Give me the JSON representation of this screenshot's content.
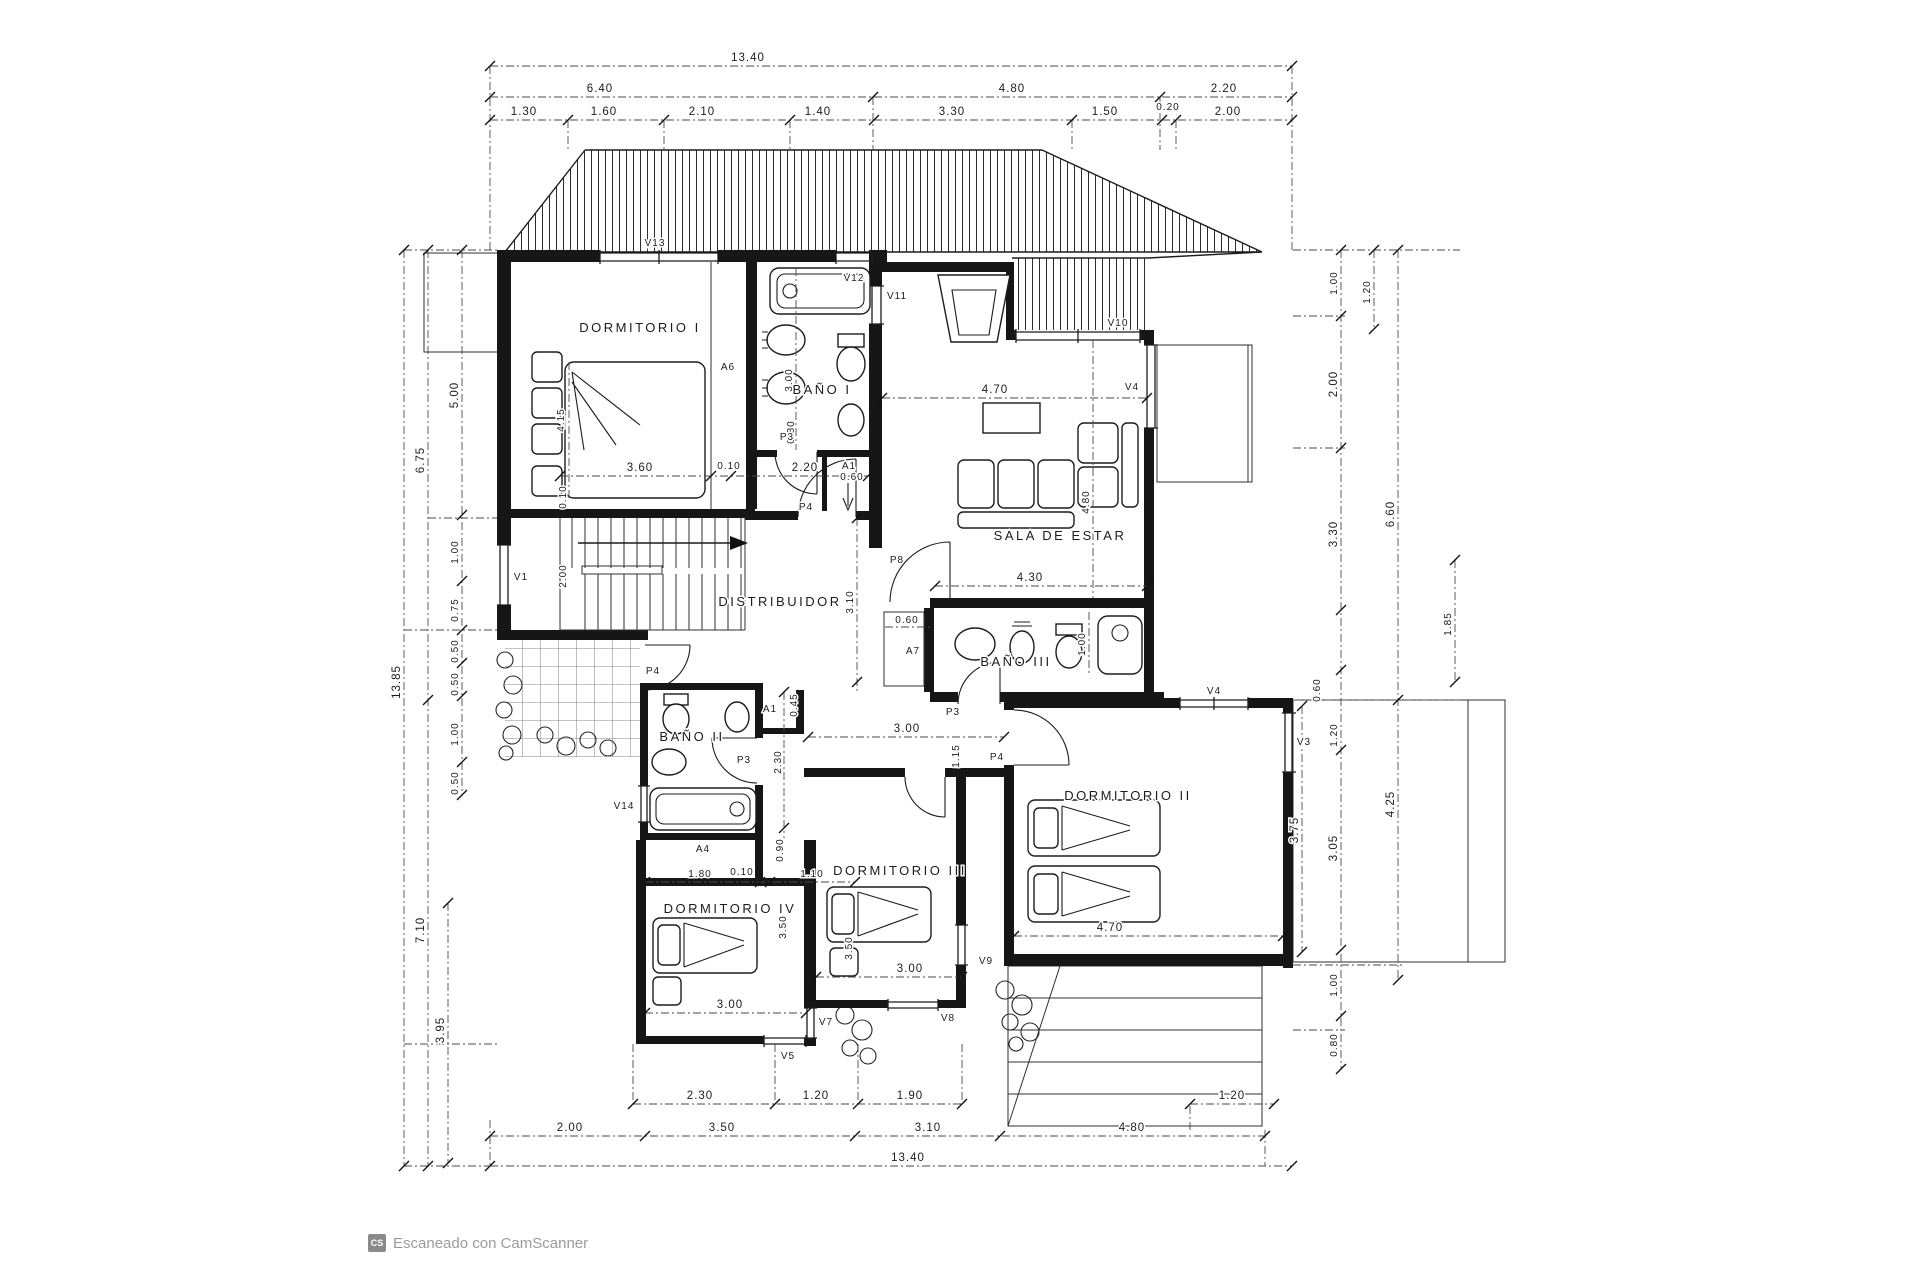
{
  "watermark": {
    "logo": "CS",
    "text": "Escaneado con CamScanner"
  },
  "rooms": {
    "dormitorio1": "DORMITORIO I",
    "bano1": "BAÑO I",
    "sala": "SALA DE ESTAR",
    "distribuidor": "DISTRIBUIDOR",
    "bano2": "BAÑO II",
    "bano3": "BAÑO III",
    "dormitorio2": "DORMITORIO II",
    "dormitorio3": "DORMITORIO III",
    "dormitorio4": "DORMITORIO IV"
  },
  "doors": {
    "p3": "P3",
    "p4": "P4",
    "p8": "P8"
  },
  "windows": {
    "v1": "V1",
    "v3": "V3",
    "v4": "V4",
    "v5": "V5",
    "v7": "V7",
    "v8": "V8",
    "v9": "V9",
    "v10": "V10",
    "v11": "V11",
    "v12": "V12",
    "v13": "V13",
    "v14": "V14"
  },
  "closets": {
    "a1": "A1",
    "a4": "A4",
    "a6": "A6",
    "a7": "A7"
  },
  "v": {
    "13_40": "13.40",
    "6_40": "6.40",
    "4_80": "4.80",
    "2_20": "2.20",
    "1_30": "1.30",
    "1_60": "1.60",
    "2_10": "2.10",
    "1_40": "1.40",
    "3_30": "3.30",
    "1_50": "1.50",
    "0_20": "0.20",
    "2_00": "2.00",
    "2_30": "2.30",
    "1_20": "1.20",
    "1_90": "1.90",
    "3_50": "3.50",
    "3_10": "3.10",
    "6_75": "6.75",
    "13_85": "13.85",
    "7_10": "7.10",
    "3_95": "3.95",
    "5_00": "5.00",
    "1_00": "1.00",
    "0_75": "0.75",
    "0_50": "0.50",
    "6_60": "6.60",
    "4_25": "4.25",
    "1_85": "1.85",
    "3_05": "3.05",
    "3_75": "3.75",
    "3_60": "3.60",
    "0_10": "0.10",
    "3_00": "3.00",
    "4_15": "4.15",
    "4_70": "4.70",
    "4_30": "4.30",
    "0_60": "0.60",
    "1_15": "1.15",
    "0_45": "0.45",
    "0_90": "0.90",
    "1_80": "1.80",
    "1_10": "1.10",
    "0_80": "0.80"
  }
}
